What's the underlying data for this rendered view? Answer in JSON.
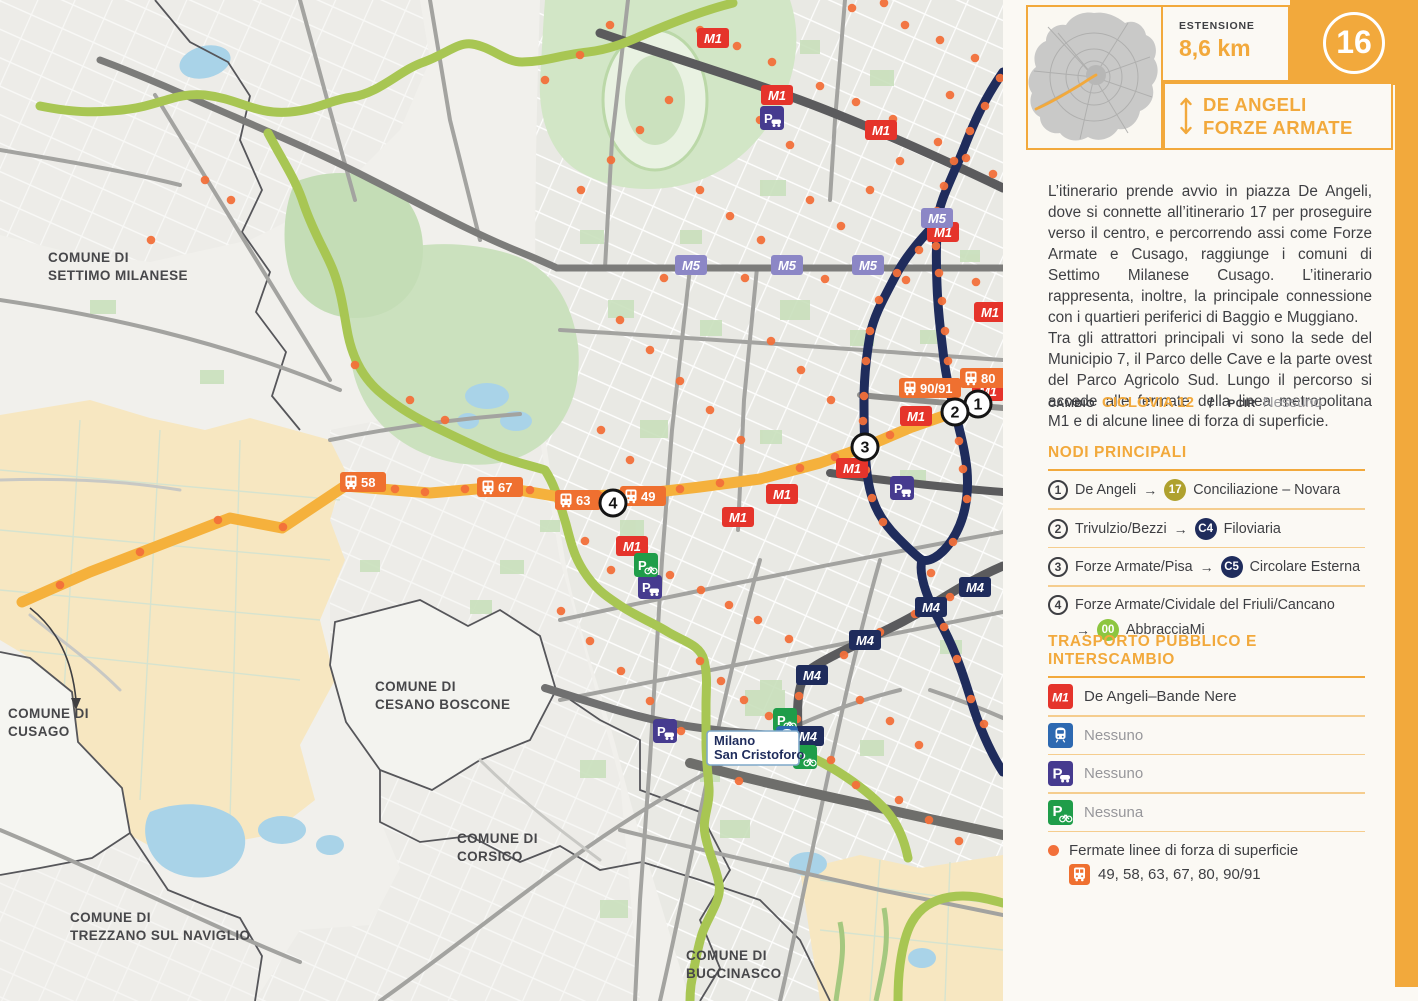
{
  "colors": {
    "accent": "#F2A93C",
    "sep": "#F5CD8E",
    "red": "#E5342B",
    "navy": "#1F2C5C",
    "lilac": "#8C87C6",
    "bus": "#EF7030",
    "dot": "#F2703A",
    "purple": "#463B8F",
    "pgreen": "#1F9D49",
    "train": "#2D69B1",
    "route": "#F5B13C",
    "green_route": "#A8C653",
    "text": "#3E3F43",
    "muted": "#97979B",
    "node17": "#AFA12E",
    "node00": "#8DC63F"
  },
  "sidebar": {
    "number": "16",
    "extension_label": "ESTENSIONE",
    "extension_value": "8,6 km",
    "title_line1": "DE ANGELI",
    "title_line2": "FORZE ARMATE",
    "description": "L’itinerario prende avvio in piazza De Angeli, dove si connette all’itinerario 17 per proseguire verso il centro, e percorrendo assi come Forze Armate e Cusago, raggiunge i comuni di Settimo Milanese Cusago. L’itinerario rappresenta, inoltre, la principale connessione con i quartieri periferici di Baggio e Muggiano.\nTra gli attrattori principali vi sono la sede del Municipio 7, il Parco delle Cave e la parte ovest del Parco Agricolo Sud. Lungo il percorso si accede alle fermate della linea metropolitana M1 e di alcune linee di forza di superficie.",
    "cambio_label": "CAMBIO",
    "cambio_value": "CICLOVIA 12",
    "slash": "/",
    "pcir_label": "PCIR",
    "pcir_value": "Nessuno",
    "nodi": {
      "heading": "NODI PRINCIPALI",
      "items": [
        {
          "num": "1",
          "before": "De Angeli",
          "arrow": "→",
          "badge": "17",
          "badge_color": "#AFA12E",
          "after": "Conciliazione – Novara",
          "wrap": false
        },
        {
          "num": "2",
          "before": "Trivulzio/Bezzi",
          "arrow": "→",
          "badge": "C4",
          "badge_color": "#1F2C5C",
          "after": "Filoviaria",
          "wrap": false
        },
        {
          "num": "3",
          "before": "Forze Armate/Pisa",
          "arrow": "→",
          "badge": "C5",
          "badge_color": "#1F2C5C",
          "after": "Circolare Esterna",
          "wrap": false
        },
        {
          "num": "4",
          "before": "Forze Armate/Cividale del Friuli/Cancano",
          "arrow": "→",
          "badge": "00",
          "badge_color": "#8DC63F",
          "after": "AbbracciaMi",
          "wrap": true
        }
      ]
    },
    "trasporto": {
      "heading": "TRASPORTO PUBBLICO E INTERSCAMBIO",
      "items": [
        {
          "icon": "m1",
          "icon_label": "M1",
          "text": "De Angeli–Bande Nere",
          "muted": false
        },
        {
          "icon": "train",
          "text": "Nessuno",
          "muted": true
        },
        {
          "icon": "p-car",
          "text": "Nessuno",
          "muted": true
        },
        {
          "icon": "p-bike",
          "text": "Nessuna",
          "muted": true
        }
      ],
      "fermate_title": "Fermate linee di forza di superficie",
      "fermate_lines": "49, 58, 63, 67, 80, 90/91"
    }
  },
  "map": {
    "comuni": [
      {
        "x": 48,
        "y": 262,
        "lines": [
          "COMUNE DI",
          "SETTIMO MILANESE"
        ]
      },
      {
        "x": 8,
        "y": 718,
        "lines": [
          "COMUNE DI",
          "CUSAGO"
        ]
      },
      {
        "x": 375,
        "y": 691,
        "lines": [
          "COMUNE DI",
          "CESANO BOSCONE"
        ]
      },
      {
        "x": 457,
        "y": 843,
        "lines": [
          "COMUNE DI",
          "CORSICO"
        ]
      },
      {
        "x": 70,
        "y": 922,
        "lines": [
          "COMUNE DI",
          "TREZZANO SUL NAVIGLIO"
        ]
      },
      {
        "x": 686,
        "y": 960,
        "lines": [
          "COMUNE DI",
          "BUCCINASCO"
        ]
      }
    ],
    "station_label": {
      "x": 707,
      "y": 731,
      "lines": [
        "Milano",
        "San Cristoforo"
      ]
    },
    "node_circles": [
      {
        "n": "1",
        "x": 978,
        "y": 404
      },
      {
        "n": "2",
        "x": 955,
        "y": 412
      },
      {
        "n": "3",
        "x": 865,
        "y": 447
      },
      {
        "n": "4",
        "x": 613,
        "y": 503
      }
    ],
    "badges": [
      {
        "t": "m1",
        "label": "M1",
        "x": 713,
        "y": 38
      },
      {
        "t": "m1",
        "label": "M1",
        "x": 777,
        "y": 95
      },
      {
        "t": "m1",
        "label": "M1",
        "x": 881,
        "y": 130
      },
      {
        "t": "m1",
        "label": "M1",
        "x": 943,
        "y": 232
      },
      {
        "t": "m1",
        "label": "M1",
        "x": 990,
        "y": 312
      },
      {
        "t": "m1",
        "label": "M1",
        "x": 988,
        "y": 391
      },
      {
        "t": "m1",
        "label": "M1",
        "x": 916,
        "y": 416
      },
      {
        "t": "m1",
        "label": "M1",
        "x": 852,
        "y": 468
      },
      {
        "t": "m1",
        "label": "M1",
        "x": 782,
        "y": 494
      },
      {
        "t": "m1",
        "label": "M1",
        "x": 738,
        "y": 517
      },
      {
        "t": "m1",
        "label": "M1",
        "x": 632,
        "y": 546
      },
      {
        "t": "m5",
        "label": "M5",
        "x": 691,
        "y": 265
      },
      {
        "t": "m5",
        "label": "M5",
        "x": 787,
        "y": 265
      },
      {
        "t": "m5",
        "label": "M5",
        "x": 868,
        "y": 265
      },
      {
        "t": "m5",
        "label": "M5",
        "x": 937,
        "y": 218
      },
      {
        "t": "m4",
        "label": "M4",
        "x": 975,
        "y": 587
      },
      {
        "t": "m4",
        "label": "M4",
        "x": 931,
        "y": 607
      },
      {
        "t": "m4",
        "label": "M4",
        "x": 865,
        "y": 640
      },
      {
        "t": "m4",
        "label": "M4",
        "x": 812,
        "y": 675
      },
      {
        "t": "m4",
        "label": "M4",
        "x": 808,
        "y": 736
      },
      {
        "t": "bus",
        "label": "58",
        "x": 363,
        "y": 482
      },
      {
        "t": "bus",
        "label": "67",
        "x": 500,
        "y": 487
      },
      {
        "t": "bus",
        "label": "63",
        "x": 578,
        "y": 500
      },
      {
        "t": "bus",
        "label": "49",
        "x": 643,
        "y": 496
      },
      {
        "t": "bus",
        "label": "90/91",
        "x": 930,
        "y": 388
      },
      {
        "t": "bus",
        "label": "80",
        "x": 983,
        "y": 378
      },
      {
        "t": "p-car",
        "x": 772,
        "y": 118
      },
      {
        "t": "p-car",
        "x": 650,
        "y": 587
      },
      {
        "t": "p-car",
        "x": 665,
        "y": 731
      },
      {
        "t": "p-car",
        "x": 902,
        "y": 488
      },
      {
        "t": "p-bike",
        "x": 646,
        "y": 565
      },
      {
        "t": "p-bike",
        "x": 785,
        "y": 720
      },
      {
        "t": "p-bike",
        "x": 805,
        "y": 757
      },
      {
        "t": "train",
        "x": 787,
        "y": 737
      }
    ],
    "stop_dots": [
      [
        700,
        30
      ],
      [
        737,
        46
      ],
      [
        772,
        62
      ],
      [
        820,
        86
      ],
      [
        856,
        102
      ],
      [
        893,
        119
      ],
      [
        938,
        142
      ],
      [
        966,
        158
      ],
      [
        993,
        174
      ],
      [
        852,
        8
      ],
      [
        884,
        3
      ],
      [
        905,
        25
      ],
      [
        940,
        40
      ],
      [
        975,
        58
      ],
      [
        950,
        95
      ],
      [
        1000,
        78
      ],
      [
        985,
        106
      ],
      [
        970,
        131
      ],
      [
        954,
        161
      ],
      [
        944,
        186
      ],
      [
        937,
        211
      ],
      [
        936,
        246
      ],
      [
        939,
        273
      ],
      [
        942,
        301
      ],
      [
        945,
        331
      ],
      [
        948,
        361
      ],
      [
        951,
        390
      ],
      [
        959,
        441
      ],
      [
        963,
        469
      ],
      [
        967,
        499
      ],
      [
        953,
        542
      ],
      [
        931,
        573
      ],
      [
        944,
        627
      ],
      [
        957,
        659
      ],
      [
        971,
        699
      ],
      [
        984,
        724
      ],
      [
        919,
        250
      ],
      [
        897,
        273
      ],
      [
        879,
        300
      ],
      [
        870,
        331
      ],
      [
        866,
        361
      ],
      [
        864,
        396
      ],
      [
        863,
        421
      ],
      [
        866,
        470
      ],
      [
        872,
        498
      ],
      [
        883,
        522
      ],
      [
        664,
        278
      ],
      [
        745,
        278
      ],
      [
        825,
        279
      ],
      [
        906,
        280
      ],
      [
        976,
        282
      ],
      [
        60,
        585
      ],
      [
        140,
        552
      ],
      [
        218,
        520
      ],
      [
        283,
        527
      ],
      [
        395,
        489
      ],
      [
        425,
        492
      ],
      [
        465,
        489
      ],
      [
        530,
        490
      ],
      [
        600,
        496
      ],
      [
        680,
        489
      ],
      [
        720,
        483
      ],
      [
        800,
        468
      ],
      [
        835,
        457
      ],
      [
        890,
        435
      ],
      [
        985,
        582
      ],
      [
        950,
        597
      ],
      [
        915,
        614
      ],
      [
        880,
        632
      ],
      [
        844,
        655
      ],
      [
        815,
        671
      ],
      [
        799,
        696
      ],
      [
        797,
        719
      ],
      [
        640,
        560
      ],
      [
        670,
        575
      ],
      [
        701,
        590
      ],
      [
        729,
        605
      ],
      [
        758,
        620
      ],
      [
        789,
        639
      ],
      [
        700,
        661
      ],
      [
        721,
        681
      ],
      [
        744,
        700
      ],
      [
        769,
        716
      ],
      [
        620,
        320
      ],
      [
        650,
        350
      ],
      [
        680,
        381
      ],
      [
        710,
        410
      ],
      [
        741,
        440
      ],
      [
        771,
        341
      ],
      [
        801,
        370
      ],
      [
        831,
        400
      ],
      [
        601,
        430
      ],
      [
        630,
        460
      ],
      [
        585,
        541
      ],
      [
        611,
        570
      ],
      [
        561,
        611
      ],
      [
        590,
        641
      ],
      [
        621,
        671
      ],
      [
        650,
        701
      ],
      [
        681,
        731
      ],
      [
        711,
        760
      ],
      [
        739,
        781
      ],
      [
        860,
        700
      ],
      [
        890,
        721
      ],
      [
        919,
        745
      ],
      [
        831,
        760
      ],
      [
        856,
        785
      ],
      [
        899,
        800
      ],
      [
        929,
        820
      ],
      [
        959,
        841
      ],
      [
        760,
        120
      ],
      [
        790,
        145
      ],
      [
        700,
        190
      ],
      [
        730,
        216
      ],
      [
        761,
        240
      ],
      [
        810,
        200
      ],
      [
        841,
        226
      ],
      [
        870,
        190
      ],
      [
        900,
        161
      ],
      [
        640,
        130
      ],
      [
        611,
        160
      ],
      [
        581,
        190
      ],
      [
        669,
        100
      ],
      [
        205,
        180
      ],
      [
        231,
        200
      ],
      [
        151,
        240
      ],
      [
        610,
        25
      ],
      [
        580,
        55
      ],
      [
        545,
        80
      ],
      [
        410,
        400
      ],
      [
        445,
        420
      ],
      [
        355,
        365
      ]
    ]
  }
}
